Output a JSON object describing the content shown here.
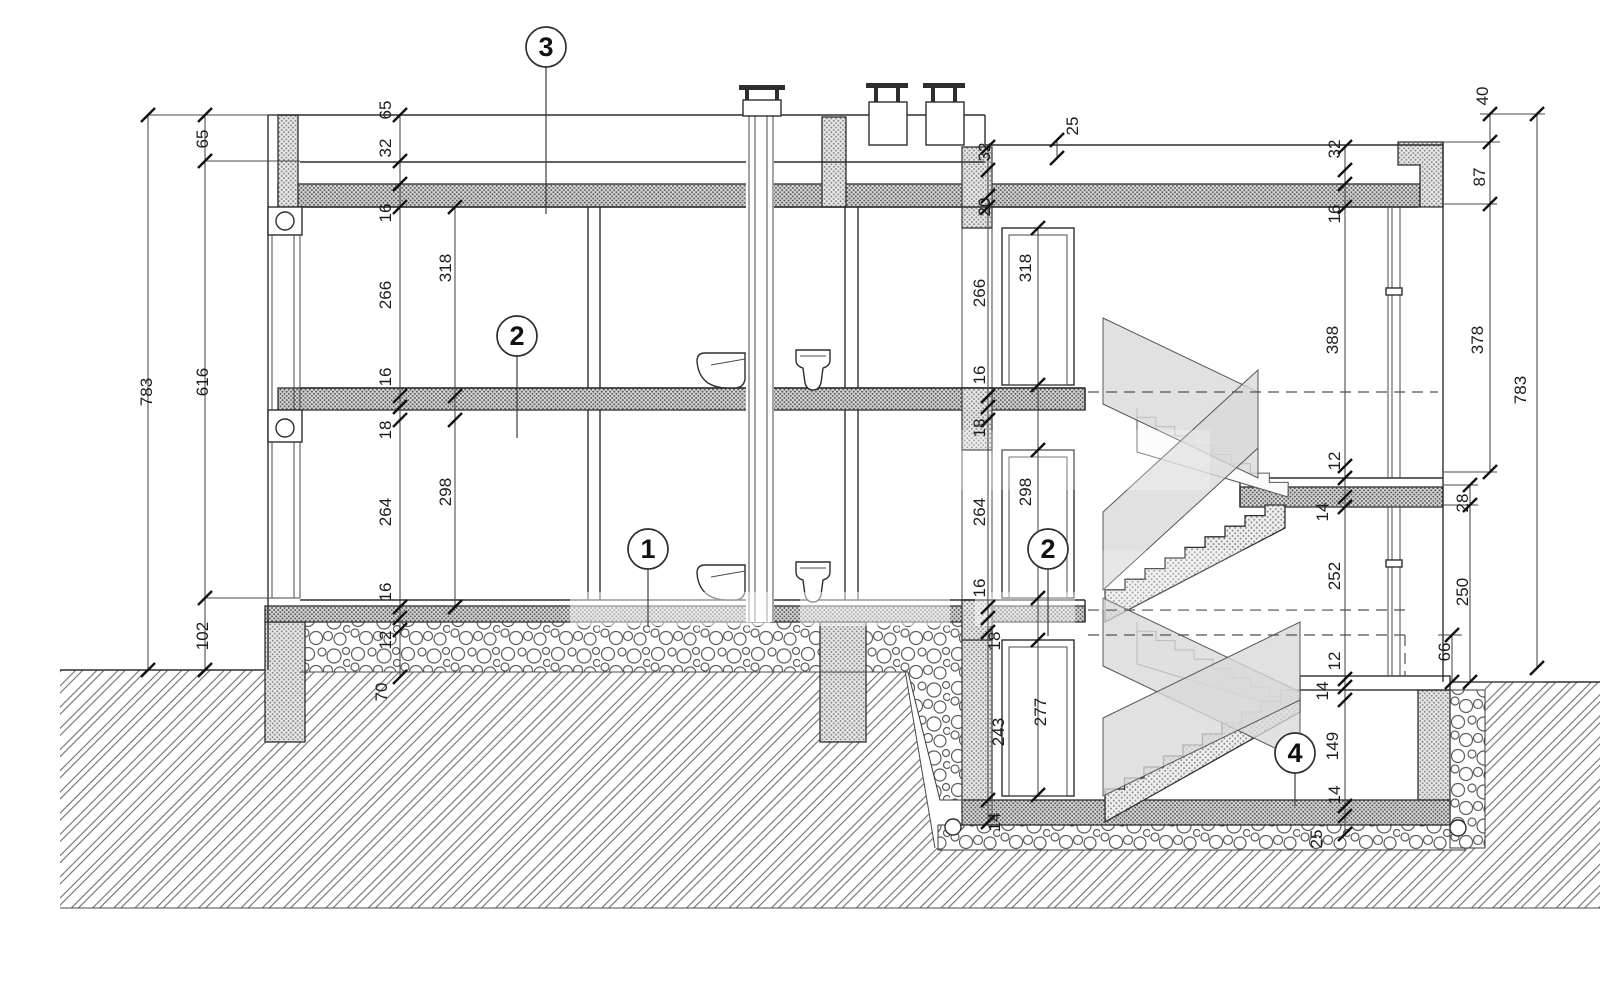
{
  "drawing": {
    "kind": "building cross-section",
    "colors": {
      "line": "#2e2e2e",
      "hatch_dot": "#8b8b8b",
      "slab_dot": "#5f5f5f",
      "panel_fill": "#d9d9d9",
      "background": "#ffffff"
    }
  },
  "annotations": {
    "callouts": [
      {
        "label": "3",
        "x": 546,
        "y": 47,
        "lx": 546,
        "ly": 214
      },
      {
        "label": "2",
        "x": 517,
        "y": 336,
        "lx": 517,
        "ly": 438
      },
      {
        "label": "1",
        "x": 648,
        "y": 549,
        "lx": 648,
        "ly": 627
      },
      {
        "label": "2",
        "x": 1048,
        "y": 549,
        "lx": 1048,
        "ly": 636
      },
      {
        "label": "4",
        "x": 1295,
        "y": 753,
        "lx": 1295,
        "ly": 806
      }
    ],
    "dimensions": [
      {
        "t": "783",
        "x": 152,
        "y": 392
      },
      {
        "t": "65",
        "x": 208,
        "y": 139
      },
      {
        "t": "616",
        "x": 208,
        "y": 382
      },
      {
        "t": "102",
        "x": 208,
        "y": 636
      },
      {
        "t": "65",
        "x": 391,
        "y": 110
      },
      {
        "t": "32",
        "x": 391,
        "y": 148
      },
      {
        "t": "16",
        "x": 391,
        "y": 213
      },
      {
        "t": "266",
        "x": 391,
        "y": 295
      },
      {
        "t": "16",
        "x": 391,
        "y": 377
      },
      {
        "t": "18",
        "x": 391,
        "y": 430
      },
      {
        "t": "264",
        "x": 391,
        "y": 512
      },
      {
        "t": "16",
        "x": 391,
        "y": 592
      },
      {
        "t": "12",
        "x": 391,
        "y": 640
      },
      {
        "t": "70",
        "x": 387,
        "y": 692
      },
      {
        "t": "318",
        "x": 451,
        "y": 268
      },
      {
        "t": "298",
        "x": 451,
        "y": 492
      },
      {
        "t": "32",
        "x": 990,
        "y": 152
      },
      {
        "t": "20",
        "x": 990,
        "y": 207
      },
      {
        "t": "266",
        "x": 985,
        "y": 293
      },
      {
        "t": "16",
        "x": 985,
        "y": 375
      },
      {
        "t": "18",
        "x": 985,
        "y": 428
      },
      {
        "t": "264",
        "x": 985,
        "y": 512
      },
      {
        "t": "16",
        "x": 985,
        "y": 588
      },
      {
        "t": "18",
        "x": 1000,
        "y": 641
      },
      {
        "t": "243",
        "x": 1004,
        "y": 732
      },
      {
        "t": "14",
        "x": 1000,
        "y": 822
      },
      {
        "t": "318",
        "x": 1031,
        "y": 268
      },
      {
        "t": "298",
        "x": 1031,
        "y": 492
      },
      {
        "t": "277",
        "x": 1046,
        "y": 712
      },
      {
        "t": "25",
        "x": 1078,
        "y": 126
      },
      {
        "t": "32",
        "x": 1340,
        "y": 149
      },
      {
        "t": "16",
        "x": 1340,
        "y": 214
      },
      {
        "t": "388",
        "x": 1338,
        "y": 340
      },
      {
        "t": "12",
        "x": 1340,
        "y": 461
      },
      {
        "t": "14",
        "x": 1328,
        "y": 512
      },
      {
        "t": "252",
        "x": 1340,
        "y": 576
      },
      {
        "t": "12",
        "x": 1340,
        "y": 661
      },
      {
        "t": "14",
        "x": 1328,
        "y": 691
      },
      {
        "t": "149",
        "x": 1338,
        "y": 746
      },
      {
        "t": "14",
        "x": 1340,
        "y": 795
      },
      {
        "t": "25",
        "x": 1322,
        "y": 839
      },
      {
        "t": "28",
        "x": 1468,
        "y": 503
      },
      {
        "t": "250",
        "x": 1468,
        "y": 592
      },
      {
        "t": "66",
        "x": 1450,
        "y": 652
      },
      {
        "t": "40",
        "x": 1488,
        "y": 96
      },
      {
        "t": "87",
        "x": 1485,
        "y": 177
      },
      {
        "t": "378",
        "x": 1483,
        "y": 340
      },
      {
        "t": "783",
        "x": 1526,
        "y": 390
      }
    ],
    "chains": [
      {
        "x": 148,
        "ys": [
          115,
          670
        ]
      },
      {
        "x": 205,
        "ys": [
          115,
          161,
          598,
          670
        ]
      },
      {
        "x": 400,
        "ys": [
          115,
          161,
          184,
          207,
          396,
          407,
          420,
          607,
          618,
          630,
          677
        ]
      },
      {
        "x": 455,
        "ys": [
          207,
          396,
          420,
          607
        ]
      },
      {
        "x": 988,
        "ys": [
          147,
          170,
          196,
          207,
          396,
          407,
          420,
          607,
          618,
          632,
          800,
          822
        ]
      },
      {
        "x": 1038,
        "ys": [
          228,
          385,
          450,
          598,
          640,
          795
        ]
      },
      {
        "x": 1057,
        "ys": [
          140,
          158
        ]
      },
      {
        "x": 1345,
        "ys": [
          147,
          170,
          184,
          207,
          466,
          478,
          497,
          507,
          679,
          687,
          700,
          806,
          816,
          834
        ]
      },
      {
        "x": 1452,
        "ys": [
          635,
          682
        ]
      },
      {
        "x": 1470,
        "ys": [
          485,
          505,
          682
        ]
      },
      {
        "x": 1490,
        "ys": [
          114,
          142,
          204,
          472
        ]
      },
      {
        "x": 1537,
        "ys": [
          114,
          668
        ]
      }
    ]
  }
}
